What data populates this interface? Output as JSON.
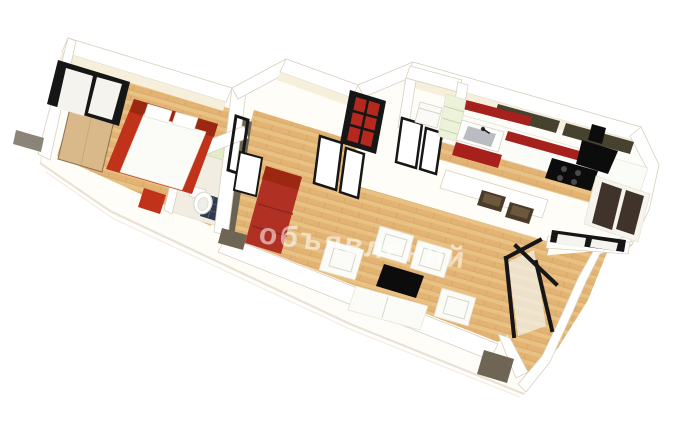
{
  "watermark": {
    "text": "объявлений",
    "color": "rgba(255,255,255,0.55)"
  },
  "palette": {
    "background": "#ffffff",
    "slab": "#fffdf8",
    "slab_edge": "#e9e2d2",
    "slab_edge_soft": "#f3eee0",
    "wall_white": "#ffffff",
    "wall_inner": "#f5efdc",
    "wall_shadow": "#eae3cf",
    "wood_base": "#e2b372",
    "wood_light": "#efcf94",
    "wood_seam": "#c8995a",
    "frame_black": "#161616",
    "pane_white": "#f4f3ee",
    "pane_glass": "#f2f0e8",
    "accent_red": "#c0331a",
    "dark_red": "#9c2812",
    "door_red": "#b5281e",
    "sofa_red": "#b03024",
    "kitchen_red": "#a6201c",
    "olive_dark": "#46422f",
    "olive_cap": "#6e6554",
    "olive_wall": "#6b6352",
    "grey_cap": "#8a8578",
    "green_shelf": "#e2ecc8",
    "green_kitchen": "#edf2da",
    "tan_wardrobe": "#d9b98a",
    "tile_dark": "#2f3a4d",
    "bath_floor": "#f1ede2",
    "appliance_black": "#0c0c0c",
    "stool_brown": "#4a3a28",
    "stool_top": "#6b583f",
    "white_furniture": "#fbfbf8",
    "pillow_white": "#ffffff",
    "sink_grey": "#b9bcc0",
    "dark_glass": "#40342a",
    "burner_grey": "#4a4a4a"
  },
  "scene": {
    "type": "3d-apartment-floor-plan-render",
    "rooms": [
      {
        "id": "bedroom",
        "items": [
          "window",
          "wardrobe",
          "double-bed",
          "bench"
        ]
      },
      {
        "id": "bathroom",
        "items": [
          "toilet",
          "tile-mat",
          "shelf"
        ]
      },
      {
        "id": "hall",
        "items": [
          "red-glass-door",
          "french-doors",
          "bedroom-door"
        ]
      },
      {
        "id": "closet",
        "items": [
          "appliance-box",
          "doors"
        ]
      },
      {
        "id": "kitchen",
        "items": [
          "upper-cabinets",
          "counter",
          "sink",
          "cooktop",
          "range-hood",
          "bar-stools",
          "shelving"
        ]
      },
      {
        "id": "living-room",
        "items": [
          "red-sofa",
          "armchairs",
          "white-sofa",
          "coffee-table"
        ]
      },
      {
        "id": "balcony",
        "items": [
          "windows"
        ]
      }
    ]
  }
}
